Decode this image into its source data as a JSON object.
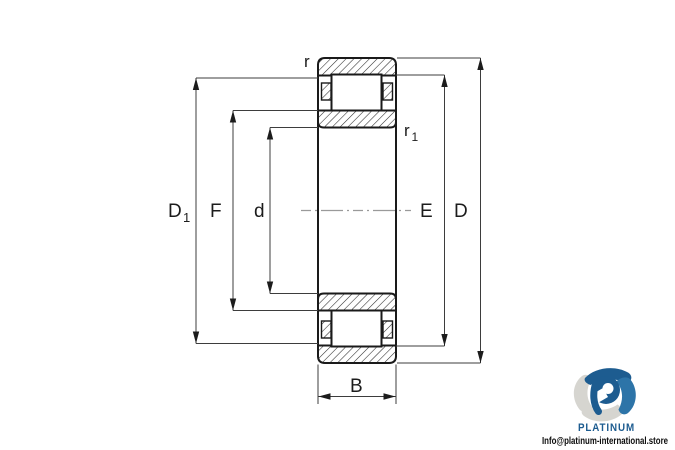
{
  "diagram": {
    "title_semantic": "cylindrical-roller-bearing-cross-section",
    "dims": {
      "d1": {
        "main": "D",
        "sub": "1"
      },
      "f": {
        "label": "F"
      },
      "d": {
        "label": "d"
      },
      "e": {
        "label": "E"
      },
      "outer_d": {
        "label": "D"
      },
      "b": {
        "label": "B"
      },
      "r": {
        "label": "r"
      },
      "r1": {
        "main": "r",
        "sub": "1"
      }
    },
    "colors": {
      "outline": "#1a1a1a",
      "hatch": "#2a2a2a",
      "dimension_lines": "#3d3d3d",
      "centerline": "#9a9a9a"
    }
  },
  "branding": {
    "name": "PLATINUM",
    "email": "Info@platinum-international.store",
    "brand_blue": "#1d5c90",
    "petal_gray": "#d6d5d0"
  }
}
